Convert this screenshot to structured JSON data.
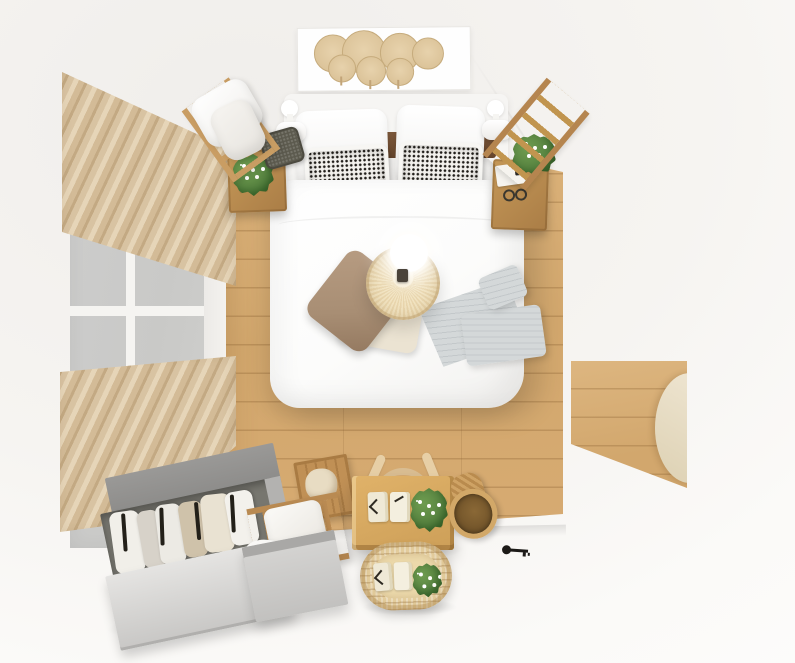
{
  "scene": {
    "type": "3d-render-top-view",
    "subject": "Scandinavian bedroom viewed from directly above",
    "objects": [
      {
        "name": "wall-art-fan-shelf",
        "detail": "white panel with seven round palm-leaf fans",
        "color": "#dcc49a"
      },
      {
        "name": "window",
        "detail": "left wall window with white mullions",
        "glass_color": "#c9c9c7"
      },
      {
        "name": "curtains",
        "detail": "two pleated beige panels over window",
        "color": "#d3bb97"
      },
      {
        "name": "wood-floor",
        "detail": "light oak planks with right-side doorway nook",
        "color": "#d2a76d"
      },
      {
        "name": "double-bed",
        "detail": "white frame, walnut headboard, white duvet",
        "color": "#fdfdfc"
      },
      {
        "name": "pillows",
        "detail": "two white pillows, two black-dot pattern pillows, taupe and cream throw pillows"
      },
      {
        "name": "rattan-pendant-lamp",
        "detail": "woven shade with glowing bulb over bed center",
        "color": "#e9d6ae"
      },
      {
        "name": "gray-throw-blanket",
        "detail": "folded striped blanket on right side of bed",
        "color": "#c3c8ca"
      },
      {
        "name": "wall-sconces",
        "detail": "white lamps each side of headboard",
        "color": "#ffffff"
      },
      {
        "name": "nightstands",
        "detail": "oak side tables with plants, book, glasses",
        "color": "#aa7d46"
      },
      {
        "name": "decor-ladders",
        "detail": "wood ladder top right, drying rack with towels top left"
      },
      {
        "name": "open-wardrobe",
        "detail": "gray clothes rack with hung garments and black hangers",
        "color": "#9a9997"
      },
      {
        "name": "storage",
        "detail": "wood crate, bottom ladder shelf with towel, gray cabinet"
      },
      {
        "name": "desk-and-chair",
        "detail": "oak desk, birch chair, notebooks, potted plant",
        "color": "#cd9f58"
      },
      {
        "name": "rattan-pouf",
        "detail": "woven oval stool with notebooks and plant",
        "color": "#e8d2a2"
      },
      {
        "name": "side-basket",
        "detail": "woven basket lying on its side",
        "color": "#b98b4e"
      },
      {
        "name": "black-key",
        "detail": "small dark object on white floor near desk"
      }
    ]
  },
  "palette": {
    "bg": "#fdfdfc",
    "wall-a": "#f0eeeb",
    "wall-b": "#f6f4f1",
    "wall-c": "#fbfaf8",
    "floor-a": "#dcb37b",
    "floor-b": "#d2a76d",
    "curt-a": "#e6d5b8",
    "curt-b": "#d3bb97",
    "curt-c": "#c3a983",
    "curt-d": "#d8c3a2",
    "glass": "#c9c9c7",
    "mullion": "#f5f4f1",
    "white": "#fdfdfc",
    "white-dim": "#f1f0ee",
    "frame-white": "#f6f5f3",
    "ink": "#221f1b",
    "headboard-a": "#7b573a",
    "headboard-b": "#65452c",
    "wood-a": "#c59858",
    "wood-b": "#aa7d46",
    "wood-light": "#e0b269",
    "wood-light2": "#cd9f58",
    "birch": "#e7cfa6",
    "birch-line": "#caa877",
    "rattan-a": "#f2e4c2",
    "rattan-b": "#e9d6ae",
    "rattan-c": "#e8d2a2",
    "taupe": "#a88e74",
    "cream": "#ebe3d2",
    "blanket-a": "#d4d8d9",
    "blanket-b": "#c3c8ca",
    "gray-top": "#9a9997",
    "gray-dark": "#77766f",
    "gray-front-a": "#e5e4e2",
    "gray-front-b": "#c8c7c5",
    "gray-side": "#b3b2b0",
    "green-a": "#4e7a3a",
    "green-b": "#6f9c50",
    "basket-a": "#cfa365",
    "basket-b": "#b98b4e",
    "basket-in": "#6e5128",
    "door-a": "#f0e7d4",
    "door-b": "#ddd1b3",
    "darkbasket": "#5c5a4e"
  }
}
